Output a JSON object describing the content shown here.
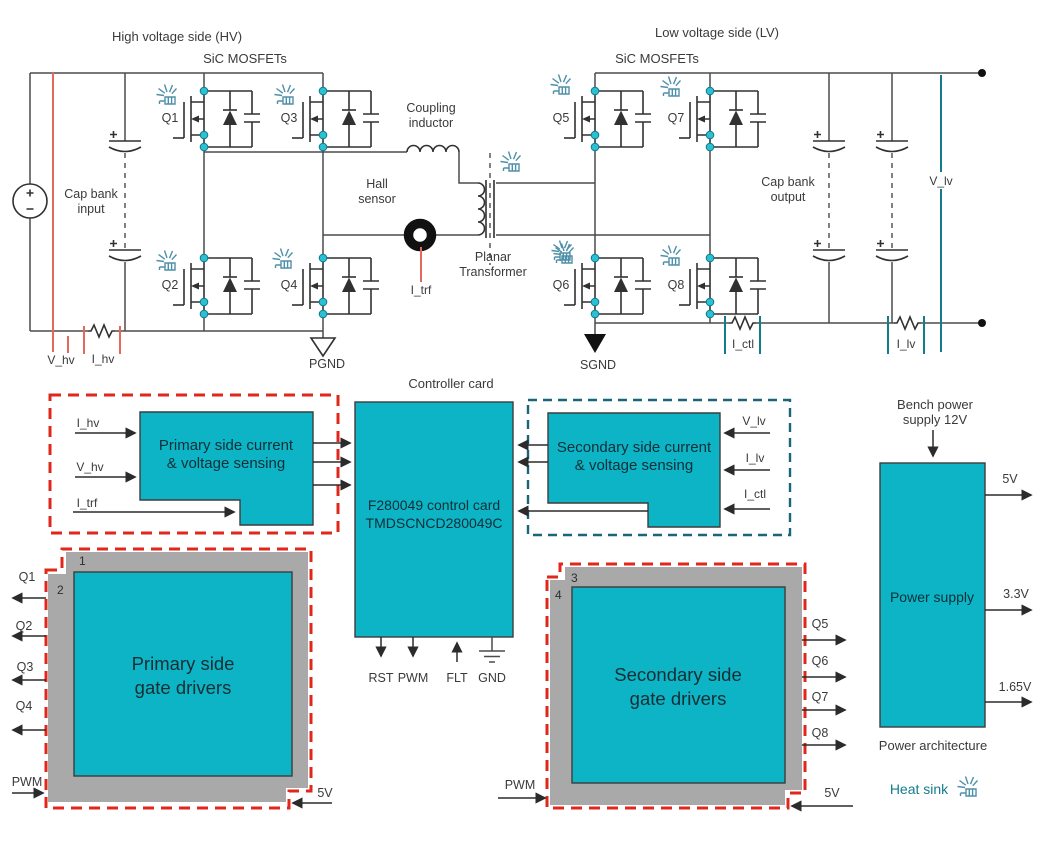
{
  "colors": {
    "teal_block": "#0db4c5",
    "gray_board": "#a9a9a9",
    "red_dashed_border": "#e0271b",
    "teal_dashed_border": "#19657a",
    "red_probe_line": "#e4685c",
    "teal_probe_line": "#147c8c",
    "node_dot": "#2cc0d2",
    "heatsink_icon": "#4f90a8"
  },
  "hv": {
    "title": "High voltage side (HV)",
    "sic": "SiC MOSFETs",
    "cap_bank_1": "Cap bank",
    "cap_bank_2": "input",
    "v_probe": "V_hv",
    "i_probe": "I_hv",
    "ground": "PGND",
    "q": [
      "Q1",
      "Q2",
      "Q3",
      "Q4"
    ]
  },
  "lv": {
    "title": "Low voltage side (LV)",
    "sic": "SiC MOSFETs",
    "cap_bank_1": "Cap bank",
    "cap_bank_2": "output",
    "v_probe": "V_lv",
    "i_ctl": "I_ctl",
    "i_lv": "I_lv",
    "ground": "SGND",
    "q": [
      "Q5",
      "Q6",
      "Q7",
      "Q8"
    ]
  },
  "link": {
    "inductor_1": "Coupling",
    "inductor_2": "inductor",
    "hall_1": "Hall",
    "hall_2": "sensor",
    "xfmr_1": "Planar",
    "xfmr_2": "Transformer",
    "i_trf": "I_trf"
  },
  "controller": {
    "title": "Controller card",
    "chip_1": "F280049 control card",
    "chip_2": "TMDSCNCD280049C",
    "pin_rst": "RST",
    "pin_pwm": "PWM",
    "pin_flt": "FLT",
    "pin_gnd": "GND"
  },
  "primary_sensing": {
    "label_1": "Primary side current",
    "label_2": "& voltage sensing",
    "in_1": "I_hv",
    "in_2": "V_hv",
    "in_3": "I_trf"
  },
  "secondary_sensing": {
    "label_1": "Secondary side current",
    "label_2": "& voltage sensing",
    "in_1": "V_lv",
    "in_2": "I_lv",
    "in_3": "I_ctl"
  },
  "primary_drivers": {
    "label_1": "Primary side",
    "label_2": "gate drivers",
    "board_a": "1",
    "board_b": "2",
    "out": [
      "Q1",
      "Q2",
      "Q3",
      "Q4"
    ],
    "pwm": "PWM",
    "vcc": "5V"
  },
  "secondary_drivers": {
    "label_1": "Secondary side",
    "label_2": "gate drivers",
    "board_a": "3",
    "board_b": "4",
    "out": [
      "Q5",
      "Q6",
      "Q7",
      "Q8"
    ],
    "pwm": "PWM",
    "vcc": "5V"
  },
  "power": {
    "bench_1": "Bench power",
    "bench_2": "supply 12V",
    "block": "Power supply",
    "out_1": "5V",
    "out_2": "3.3V",
    "out_3": "1.65V",
    "caption": "Power architecture"
  },
  "legend": {
    "heat_sink": "Heat sink"
  }
}
